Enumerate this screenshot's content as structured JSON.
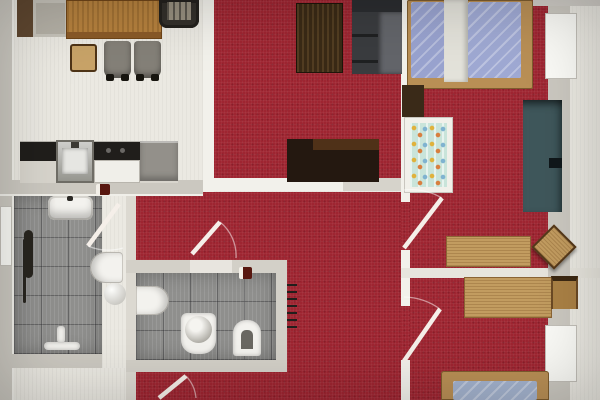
{
  "document": {
    "kind": "floor-plan",
    "view": "top-down-render",
    "text_visible": ""
  },
  "colors": {
    "carpet": "#9e2531",
    "floorLight": "#ebe9e2",
    "tile": "#8f8f8d",
    "wall": "#cbc8c0",
    "wallWhite": "#f2f1eb",
    "woodTable": "#b5813e",
    "woodFrame": "#b98f55",
    "woodDesk": "#c29c60",
    "woodDark": "#3a2a16",
    "tvDark": "#241810",
    "sofaDark": "#3a3c3f",
    "sofaSeat": "#63656a",
    "teal": "#3f575b",
    "bedBlue": "#9fa9d3",
    "mattressBlue": "#a3b2cd",
    "cribMint": "#c9e4da",
    "fixture": "#f3f2ee",
    "accessoryRed": "#58170f"
  },
  "rooms": [
    {
      "id": "dining-kitchen",
      "floor": "light-wood"
    },
    {
      "id": "living-room",
      "floor": "red-carpet"
    },
    {
      "id": "bedroom-top-right",
      "floor": "red-carpet"
    },
    {
      "id": "bedroom-bottom-right",
      "floor": "red-carpet"
    },
    {
      "id": "bedroom-middle",
      "floor": "red-carpet"
    },
    {
      "id": "bathroom",
      "floor": "gray-tile"
    },
    {
      "id": "wc",
      "floor": "gray-tile"
    },
    {
      "id": "hallway",
      "floor": "light-wood"
    }
  ],
  "furniture": [
    "sideboard",
    "dining-table",
    "armchair",
    "wood-chair",
    "gray-chair",
    "gray-chair",
    "kitchen-counter",
    "kitchen-sink",
    "cooktop",
    "coffee-table",
    "sofa",
    "tv-lowboard",
    "double-bed",
    "nightstand",
    "baby-crib",
    "teal-daybed",
    "desk",
    "desk-chair",
    "desk",
    "desk-chair",
    "single-bed",
    "bath-sink",
    "towel-radiator",
    "toilet",
    "laundry-basket",
    "shower-mixer",
    "wc-toilet",
    "wc-basin",
    "wc-bidet"
  ],
  "doors": [
    {
      "id": "bathroom-door"
    },
    {
      "id": "wc-door"
    },
    {
      "id": "bedroom-top-right-door"
    },
    {
      "id": "bedroom-bottom-right-door"
    },
    {
      "id": "entry-door"
    }
  ],
  "windows": [
    {
      "id": "window-left"
    },
    {
      "id": "window-right-top"
    },
    {
      "id": "window-right-bottom"
    }
  ],
  "radiator": {
    "ticks": 7
  }
}
